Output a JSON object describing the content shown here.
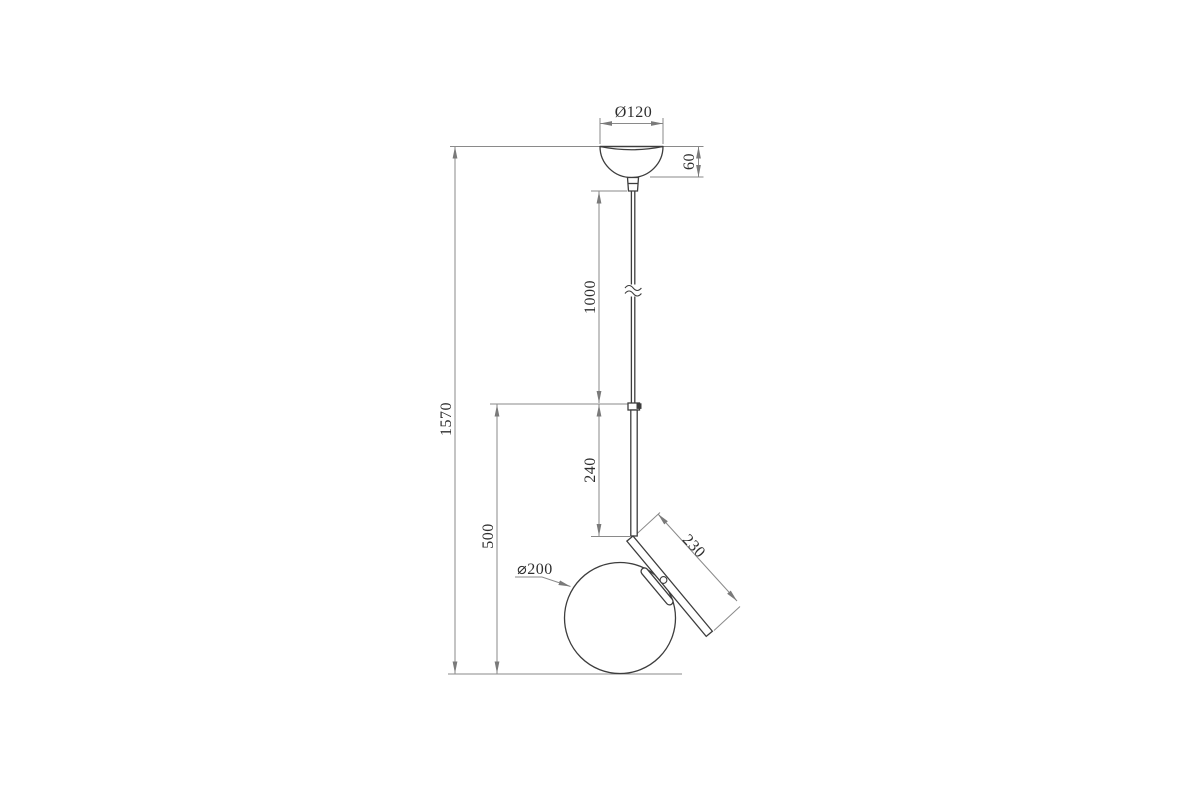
{
  "drawing": {
    "type": "technical-dimension-drawing",
    "subject": "pendant-lamp-elevation",
    "labels": {
      "canopy_diameter": "Ø120",
      "canopy_height": "60",
      "suspension_length": "1000",
      "overall_height": "1570",
      "stem_length": "240",
      "arm_length": "230",
      "shade_diameter": "⌀200",
      "shade_drop_height": "500"
    },
    "colors": {
      "background": "#ffffff",
      "object_line": "#3d3d3d",
      "dimension_line": "#8a8a8a",
      "arrow_fill": "#7a7a7a",
      "text": "#2e2e2e"
    }
  }
}
